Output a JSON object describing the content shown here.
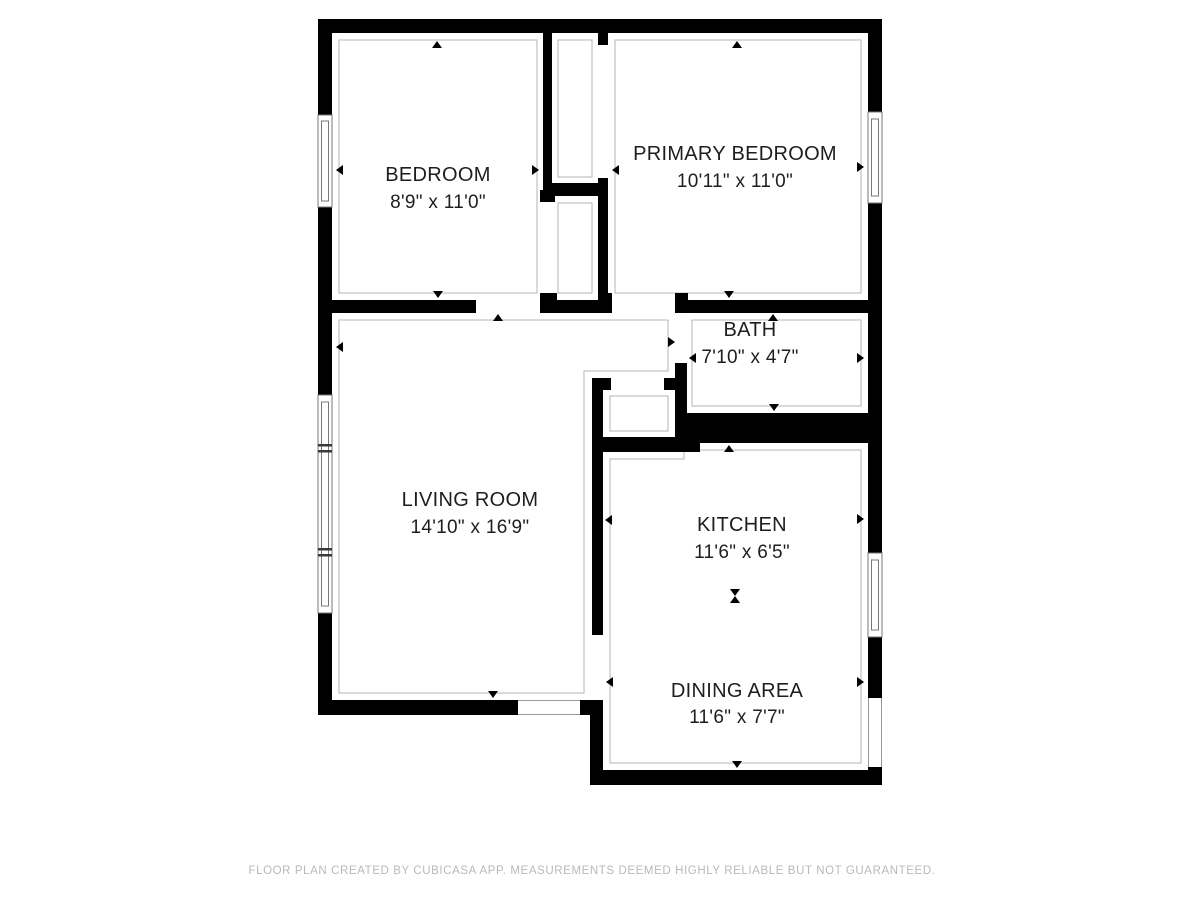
{
  "floor_plan": {
    "app_attribution": "CubiCasa",
    "rooms": [
      {
        "name": "BEDROOM",
        "dimensions": "8'9\" x 11'0\""
      },
      {
        "name": "PRIMARY BEDROOM",
        "dimensions": "10'11\" x 11'0\""
      },
      {
        "name": "BATH",
        "dimensions": "7'10\" x 4'7\""
      },
      {
        "name": "LIVING ROOM",
        "dimensions": "14'10\" x 16'9\""
      },
      {
        "name": "KITCHEN",
        "dimensions": "11'6\" x 6'5\""
      },
      {
        "name": "DINING AREA",
        "dimensions": "11'6\" x 7'7\""
      }
    ],
    "footer": "FLOOR PLAN CREATED BY CUBICASA APP. MEASUREMENTS DEEMED HIGHLY RELIABLE BUT NOT GUARANTEED.",
    "colors": {
      "wall": "#000000",
      "room_outline": "#b4b4b4",
      "window_frame": "#777777",
      "label_text": "#1e1e1e",
      "footer_text": "#b9b9b9",
      "background": "#ffffff"
    }
  }
}
